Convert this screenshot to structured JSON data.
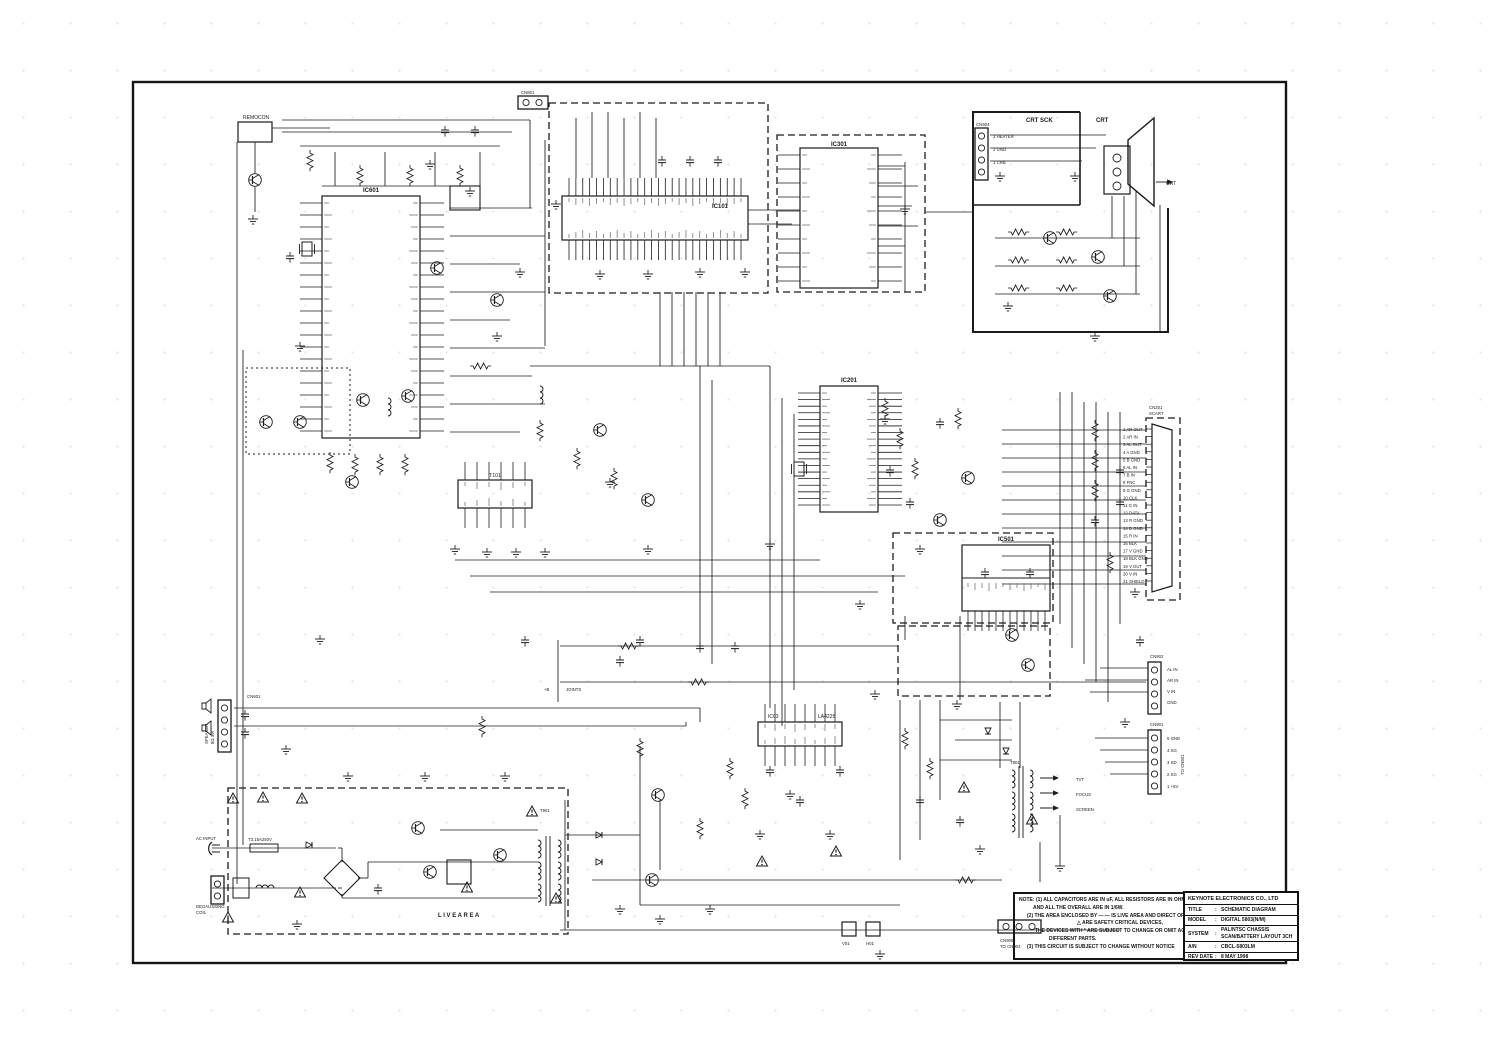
{
  "title_block": {
    "company": "KEYNOTE ELECTRONICS CO., LTD",
    "rows": [
      {
        "label": "TITLE",
        "sep": ":",
        "value": "SCHEMATIC DIAGRAM"
      },
      {
        "label": "MODEL",
        "sep": ":",
        "value": "DIGITAL 5803(N/M)"
      },
      {
        "label": "SYSTEM",
        "sep": ":",
        "value": "PAL/NTSC CHASSIS",
        "value2": "SCAN/BATTERY LAYOUT 3CH"
      },
      {
        "label": "A/N",
        "sep": ":",
        "value": "CBCL-5803LM"
      },
      {
        "label": "REV DATE",
        "sep": ":",
        "value": "8 MAY 1998"
      }
    ]
  },
  "notes": {
    "line1": "NOTE: (1) ALL CAPACITORS ARE IN uF,   ALL RESISTORS ARE IN OHM,   ALL FIXED VALUE CAN",
    "line2": "AND ALL THE OVERALL ARE IN 1/6W.",
    "line3": "(2) THE AREA ENCLOSED BY  — —  IS LIVE AREA AND DIRECT OF CONNECTED",
    "line4": "△  ARE SAFETY CRITICAL DEVICES,",
    "line5": "THE DEVICES WITH  *  ARE SUBJECT TO CHANGE OR OMIT  ACCORDING  AS",
    "line6": "DIFFERENT PARTS.",
    "line7": "(3) THIS CIRCUIT IS SUBJECT TO CHANGE WITHOUT NOTICE"
  },
  "ics": {
    "micro": "IC601",
    "video_if": "IC101",
    "memory": "IC301",
    "jungle": "IC201",
    "osd": "IC501",
    "audio": "IC03",
    "audio_part": "LA4225",
    "saw": "T101"
  },
  "crt": {
    "socket_label": "CRT SCK",
    "crt_label": "CRT",
    "arrow_label": "CRT",
    "connector": "CN904",
    "pin3": "3 HEATER",
    "pin2": "2 GND",
    "pin1": "1 CRB"
  },
  "scart": {
    "name": "CN201",
    "type": "SCART",
    "pins": [
      "1 AR OUT",
      "2 AR IN",
      "3 AL OUT",
      "4 A GND",
      "5 B GND",
      "6 AL IN",
      "7 B IN",
      "8 FNC",
      "9 G GND",
      "10 CLK",
      "11 G IN",
      "12 DATA",
      "13 R GND",
      "14 D GND",
      "15 R IN",
      "16 BLK",
      "17 V GND",
      "18 BLK GND",
      "19 V OUT",
      "20 V IN",
      "21 SHIELD"
    ]
  },
  "connectors": {
    "cn902": {
      "name": "CN902",
      "pins": [
        "AL IN",
        "AR IN",
        "V IN",
        "GND"
      ]
    },
    "cn901": {
      "name": "CN901",
      "dest": "TO CN901",
      "pins": [
        "5 GND",
        "4 SG",
        "3 SD",
        "2 SG",
        "1 +5V"
      ]
    },
    "cn601": {
      "name": "CN601",
      "speaker1": "SPEAKER",
      "speaker2": "8Ω 3W"
    },
    "cn801": {
      "name": "CN801"
    },
    "cn905": {
      "name": "CN905",
      "dest": "TO CN904"
    },
    "v01": "V01",
    "h01": "H01"
  },
  "power": {
    "ac_input": "AC INPUT",
    "degauss1": "DEGAUSSING",
    "degauss2": "COIL",
    "fuse": "T3.15A250V",
    "live_area": "L I V E    A R E A",
    "transformer": "T901"
  },
  "fbt": {
    "name": "T801",
    "out1": "TVT",
    "out2": "FOCUS",
    "out3": "SCREEN"
  },
  "misc": {
    "remocon": "REMOCON",
    "joints": "JOINTS",
    "plus_b": "+B"
  }
}
